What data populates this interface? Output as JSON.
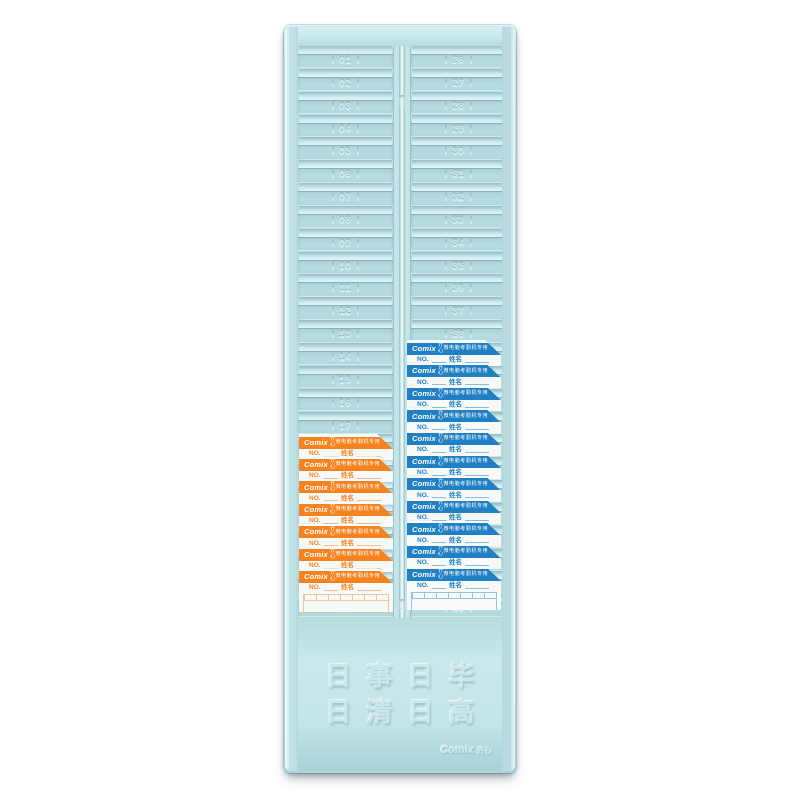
{
  "rack": {
    "left_column_numbers": [
      "01",
      "02",
      "03",
      "04",
      "05",
      "06",
      "07",
      "08",
      "09",
      "10",
      "11",
      "12",
      "13",
      "14",
      "15",
      "16",
      "17",
      "18",
      "19",
      "20",
      "21",
      "22",
      "23",
      "24",
      "25"
    ],
    "right_column_numbers": [
      "26",
      "27",
      "28",
      "29",
      "30",
      "31",
      "32",
      "33",
      "34",
      "35",
      "36",
      "37",
      "38",
      "39",
      "40",
      "41",
      "42",
      "43",
      "44",
      "45",
      "46",
      "47",
      "48",
      "49",
      "50"
    ],
    "footer": {
      "slogan_line1": "日事日毕",
      "slogan_line2": "日清日高",
      "brand": "Comix",
      "brand_cn": "齐心"
    }
  },
  "time_card": {
    "brand": "Comix",
    "brand_cn": "齐心",
    "header_note": "微电脑考勤机专用",
    "no_label": "NO.",
    "name_label": "姓名"
  },
  "stacks": {
    "left": {
      "accent": "#f6831f",
      "count": 7,
      "top": 409,
      "pitch": 22.4,
      "x": 15,
      "width": 94
    },
    "right": {
      "accent": "#2180c3",
      "count": 11,
      "top": 315,
      "pitch": 22.6,
      "x": 123,
      "width": 94
    }
  },
  "colors": {
    "rack_body": "#b4dade",
    "card_orange": "#f6831f",
    "card_blue": "#2180c3",
    "card_paper": "#f7faf9"
  }
}
